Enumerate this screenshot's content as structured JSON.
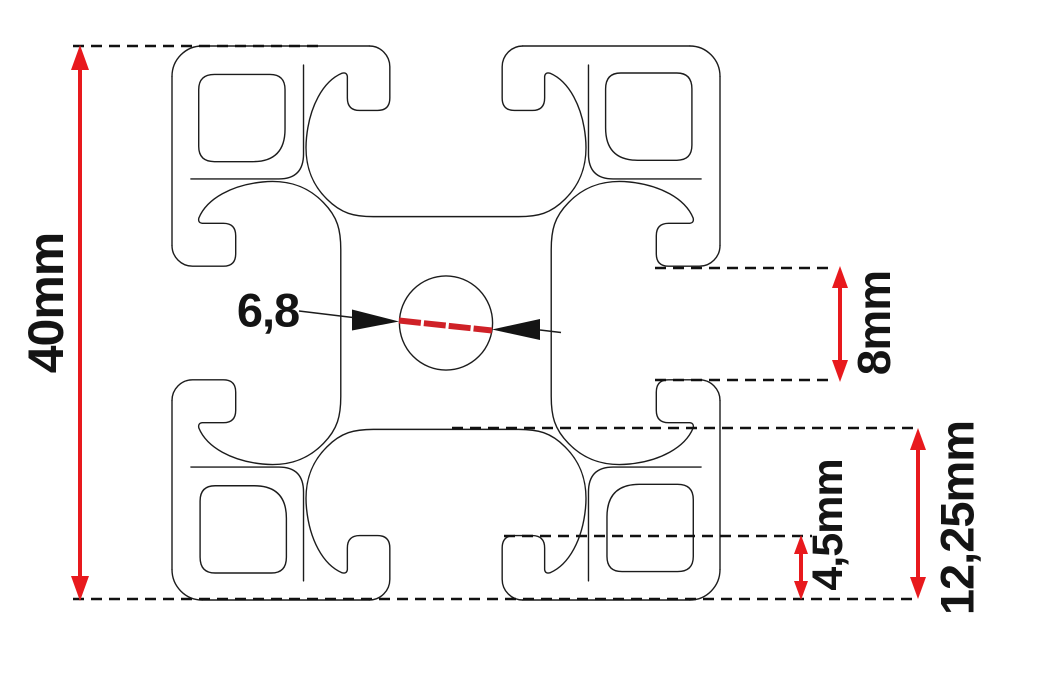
{
  "diagram": {
    "type": "technical-cross-section",
    "subject": "40x40 aluminium T-slot extrusion profile",
    "units": "mm",
    "dimensions": {
      "overall_height": {
        "label": "40mm",
        "value_mm": 40,
        "orientation": "vertical-left"
      },
      "slot_opening": {
        "label": "8mm",
        "value_mm": 8,
        "orientation": "vertical-right"
      },
      "lip_depth": {
        "label": "4,5mm",
        "value_mm": 4.5,
        "orientation": "vertical-bottom-right"
      },
      "cavity_depth": {
        "label": "12,25mm",
        "value_mm": 12.25,
        "orientation": "vertical-bottom-right"
      },
      "center_bore": {
        "label": "6,8",
        "value_mm": 6.8,
        "orientation": "callout-center"
      }
    },
    "colors": {
      "dimension_arrow_red": "#e8191d",
      "bore_diameter_red": "#cf2127",
      "outline_black": "#1c1c1c",
      "text_black": "#141414",
      "background": "#ffffff"
    }
  }
}
